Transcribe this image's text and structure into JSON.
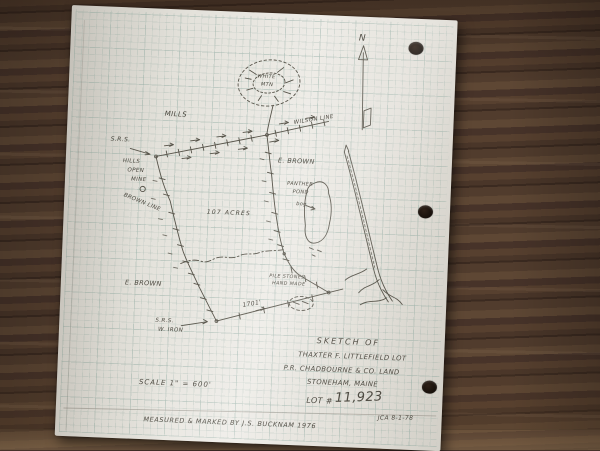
{
  "north": {
    "label": "N"
  },
  "map_labels": {
    "mills": "MILLS",
    "srs_top": "S.R.S.",
    "hills": "HILLS",
    "open": "OPEN",
    "mine": "MINE",
    "brown_line": "BROWN LINE",
    "wilson_line": "WILSON LINE",
    "e_brown_right": "E. BROWN",
    "mtn_line1": "WHITE",
    "mtn_line2": "MTN",
    "pond_line1": "PANTHER",
    "pond_line2": "POND",
    "bog": "bog",
    "acreage": "107 ACRES",
    "e_brown_left": "E. BROWN",
    "srs_bottom": "S.R.S.",
    "w_iron": "W. IRON",
    "dist_1701": "1701'",
    "pile_stones_line1": "PILE STONES",
    "pile_stones_line2": "HAND MADE"
  },
  "title_block": {
    "line1": "SKETCH OF",
    "line2": "THAXTER F. LITTLEFIELD LOT",
    "line3": "P.R. CHADBOURNE & CO. LAND",
    "line4": "STONEHAM, MAINE",
    "lot_label": "LOT #",
    "lot_value": "11,923"
  },
  "scale_note": "SCALE 1\" = 600'",
  "footer": {
    "left": "MEASURED & MARKED BY J.S. BUCKNAM 1976",
    "right": "JCA 8-1-78"
  }
}
